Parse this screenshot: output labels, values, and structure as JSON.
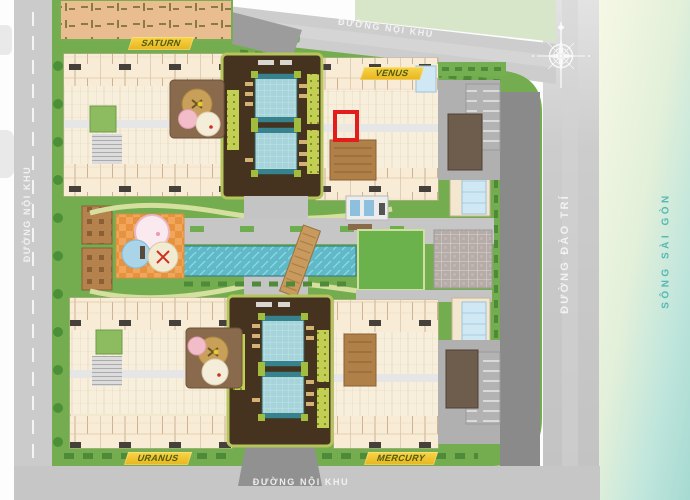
{
  "plan": {
    "roads": {
      "top": "ĐƯỜNG NỘI KHU",
      "left": "ĐƯỜNG NỘI KHU",
      "bottom": "ĐƯỜNG NỘI KHU",
      "right": "ĐƯỜNG ĐÀO TRÍ"
    },
    "river": {
      "name": "SÔNG SÀI GÒN"
    },
    "towers": {
      "saturn": "SATURN",
      "venus": "VENUS",
      "uranus": "URANUS",
      "mercury": "MERCURY"
    },
    "marker": {
      "color": "#e31c1c"
    },
    "icons": {
      "compass": "compass-rose-icon"
    },
    "colors": {
      "lawn": "#74ad4f",
      "deck": "#46331f",
      "tower_pool": "#9fd0d8",
      "lap_pool": "#5fb9c9",
      "road": "#c9c9c9",
      "internal_road": "#8a8a8a",
      "river_near": "#f5f7e3",
      "river_far": "#a6dad2",
      "river_text": "#55b8b2",
      "unit_fill": "#f8ecd6",
      "tower_label_bg": "#f0c432",
      "tower_label_text": "#4e5c10",
      "playground_orange": "#f0a75c",
      "marker_red": "#e31c1c"
    }
  }
}
